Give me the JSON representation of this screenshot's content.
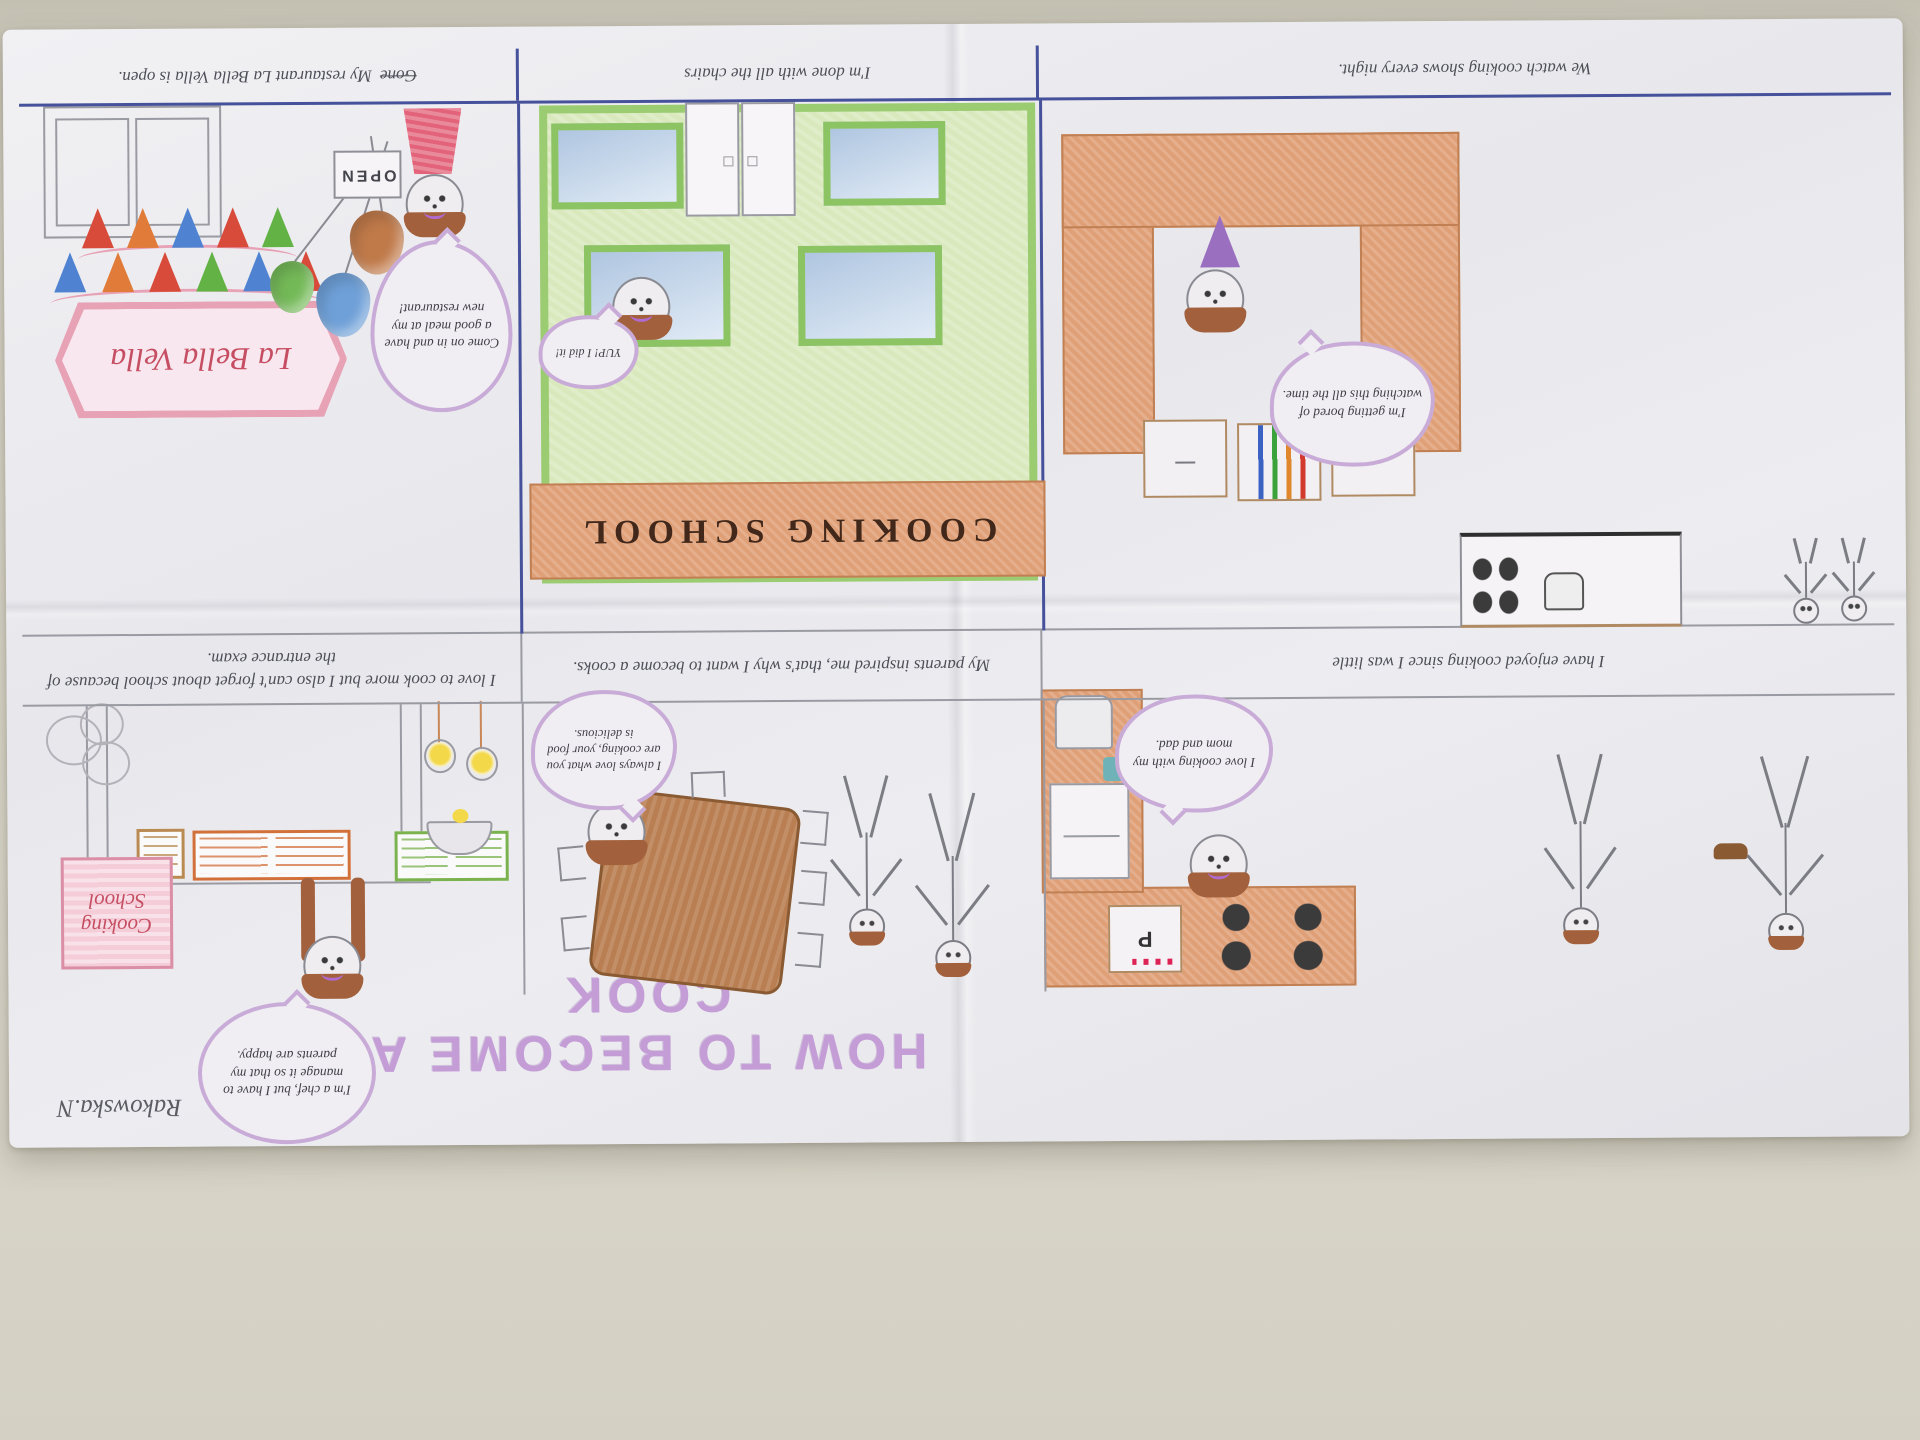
{
  "poster": {
    "title": "HOW TO BECOME A COOK",
    "signature": "Rakowska.N",
    "row1": {
      "captions": [
        "I have enjoyed cooking since I was little",
        "My parents inspired me, that's why I want to become a cooks.",
        "I love to cook more but I also can't forget about school because of the entrance exam."
      ],
      "panels": {
        "home_kitchen": {
          "bubble": "I love cooking with my mom and dad.",
          "oven_letter": "P"
        },
        "dining_room": {
          "bubble": "I always love what you are cooking, your food is delicious."
        },
        "study_room": {
          "bubble": "I'm a chef, but I have to manage it so that my parents are happy.",
          "sign": "Cooking School"
        }
      }
    },
    "row2": {
      "captions": [
        {
          "struck": "",
          "text": "We watch cooking shows every night."
        },
        {
          "struck": "",
          "text": "I'm done with all the chairs"
        },
        {
          "struck": "Gone",
          "text": "My restaurant La Bella Vella is open."
        }
      ],
      "panels": {
        "big_kitchen": {
          "bubble": "I'm getting bored of watching this all the time."
        },
        "cooking_school": {
          "bubble": "YUP! I did it!",
          "sign": "COOKING SCHOOL"
        },
        "restaurant": {
          "bubble": "Come on in and have a good meal at my new restaurant!",
          "sign": "La Bella Vella",
          "door_sign": "OPEN",
          "bunting_rows": [
            [
              "#d84b3a",
              "#4f83d2",
              "#63b246",
              "#d84b3a",
              "#e07b3a",
              "#4f83d2"
            ],
            [
              "#63b246",
              "#d84b3a",
              "#4f83d2",
              "#e07b3a",
              "#d84b3a"
            ]
          ],
          "balloon_colors": [
            "#9a7bc8",
            "#6fa0d8",
            "#74b958",
            "#c07a4a"
          ]
        }
      }
    },
    "colors": {
      "marker_purple": "#c49dd6",
      "bubble_outline": "#c9abd8",
      "pen_blue": "#46519b",
      "pencil_gray": "#9a9aa2",
      "crayon_orange": "#e0a077",
      "building_green": "#d9e9bd",
      "frame_green": "#9bcc72",
      "window_blue": "#c2d6ec",
      "sign_text_brown": "#42281a",
      "pink_sign": "#e8a2b6",
      "red_text": "#c64e62",
      "table_brown": "#b97f52"
    }
  }
}
